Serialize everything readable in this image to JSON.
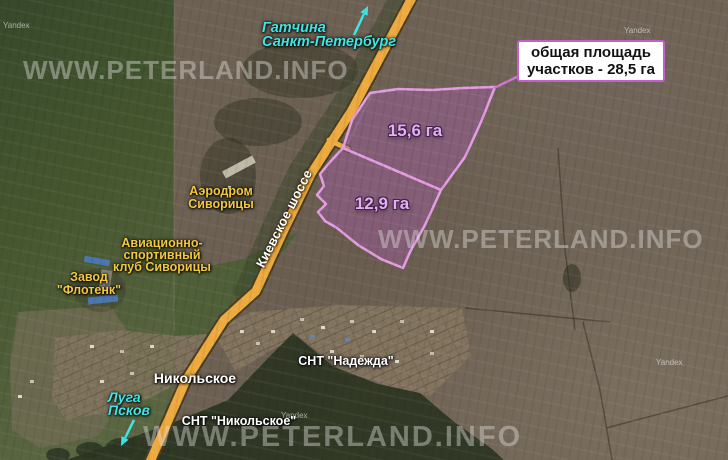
{
  "info_box": {
    "line1": "общая площадь",
    "line2": "участков - 28,5 га"
  },
  "plots": [
    {
      "label": "15,6 га"
    },
    {
      "label": "12,9 га"
    }
  ],
  "road": {
    "name": "Киевское шоссе"
  },
  "directions": {
    "north": {
      "line1": "Гатчина",
      "line2": "Санкт-Петербург"
    },
    "south": {
      "line1": "Луга",
      "line2": "Псков"
    }
  },
  "places": {
    "aerodrome": {
      "line1": "Аэродром",
      "line2": "Сиворицы"
    },
    "aviaclub": {
      "line1": "Авиационно-",
      "line2": "спортивный",
      "line3": "клуб Сиворицы"
    },
    "factory": {
      "line1": "Завод",
      "line2": "\"Флотенк\""
    },
    "village": "Никольское",
    "snt_nadezhda": "СНТ \"Надежда\"",
    "snt_nikolskoe": "СНТ \"Никольское\""
  },
  "watermark": {
    "site": "WWW.PETERLAND.INFO",
    "provider": "Yandex"
  },
  "colors": {
    "plot_fill": "#8e6f88",
    "plot_stroke": "#e49ce4",
    "road": "#edaa3f",
    "highlight_cyan": "#3fe6e6",
    "label_yellow": "#f2c83e",
    "box_border": "#c75ece"
  }
}
